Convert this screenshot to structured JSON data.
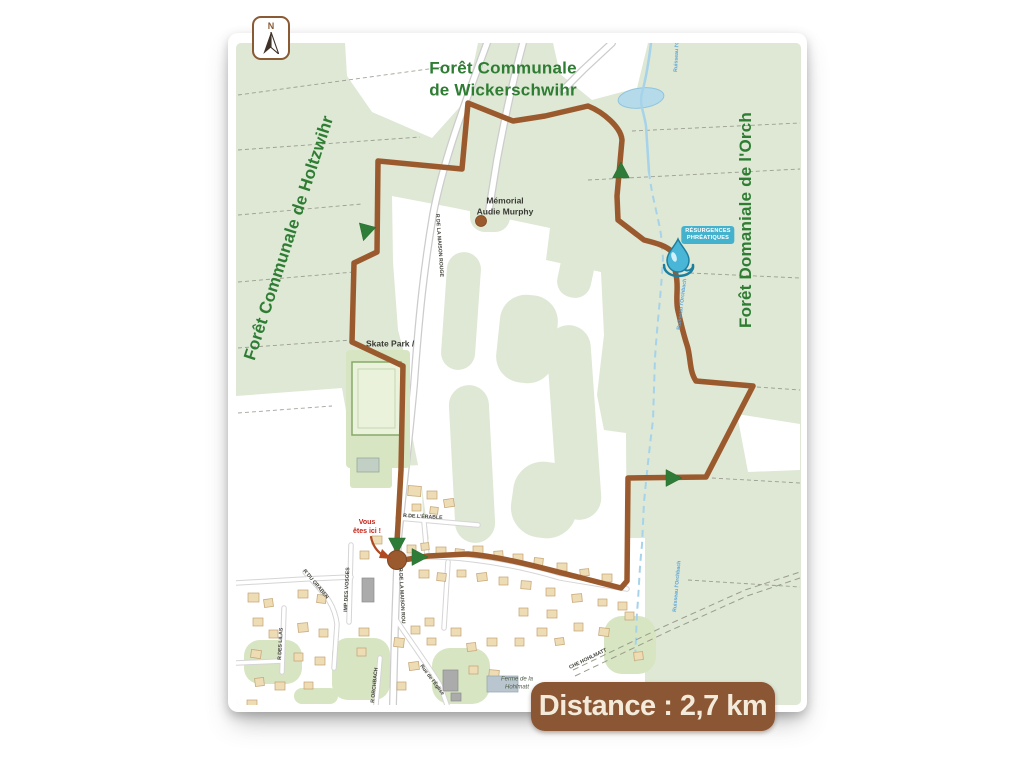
{
  "distance_badge": {
    "label": "Distance : 2,7 km"
  },
  "compass": {
    "letter": "N"
  },
  "forest_labels": [
    {
      "line1": "Forêt Communale",
      "line2": "de Wickerschwihr"
    },
    {
      "line1": "Forêt Communale de Holtzwihr"
    },
    {
      "line1": "Forêt Domaniale de l'Orch"
    }
  ],
  "poi": {
    "memorial": {
      "line1": "Mémorial",
      "line2": "Audie Murphy"
    },
    "skatepark": {
      "label": "Skate Park /"
    },
    "you_are_here": {
      "line1": "Vous",
      "line2": "êtes ici !"
    },
    "farm": {
      "line1": "Ferme de la",
      "line2": "Hohlmatt"
    },
    "resurgences": {
      "line1": "RÉSURGENCES",
      "line2": "PHRÉATIQUES"
    }
  },
  "street_labels": [
    {
      "text": "R DE LA MAISON ROUGE",
      "x": 436,
      "y": 214,
      "rot": 86
    },
    {
      "text": "R DE LA MAISON ROU",
      "x": 399,
      "y": 568,
      "rot": 87
    },
    {
      "text": "R DE L'ÉRABLE",
      "x": 403,
      "y": 517,
      "rot": 3
    },
    {
      "text": "IMP DES VOSGES",
      "x": 347,
      "y": 612,
      "rot": -87
    },
    {
      "text": "Rue de l'Église",
      "x": 420,
      "y": 666,
      "rot": 53
    },
    {
      "text": "R ORCHBACH",
      "x": 374,
      "y": 703,
      "rot": -84
    },
    {
      "text": "R DES LILAS",
      "x": 281,
      "y": 660,
      "rot": -87
    },
    {
      "text": "R DU GRABEN",
      "x": 303,
      "y": 571,
      "rot": 50
    },
    {
      "text": "CHE HOHLMATT",
      "x": 570,
      "y": 669,
      "rot": -26
    }
  ],
  "stream_labels": [
    {
      "text": "Ruisseau l'Orch",
      "x": 677,
      "y": 72,
      "rot": -87
    },
    {
      "text": "Ruisseau l'Orchbach",
      "x": 680,
      "y": 330,
      "rot": -83
    },
    {
      "text": "Ruisseau l'Orchbach",
      "x": 676,
      "y": 612,
      "rot": -85
    }
  ],
  "colors": {
    "forest": "#dee8d5",
    "clearing": "#ffffff",
    "park": "#d7e5c2",
    "trail": "#9b5a2d",
    "trail_dark": "#7e451f",
    "arrow": "#2e7c37",
    "water": "#a6d3ea",
    "water_text": "#5aa3d8",
    "building": "#eedcb4",
    "building_stroke": "#c3a273",
    "gray_building": "#ababab",
    "gray_building_stroke": "#8d8d8d",
    "blue_building": "#b9c6cf",
    "blue_building_stroke": "#93a3ad",
    "road_casing": "#cccccc",
    "parcel": "#85857a",
    "street_text": "#44443c",
    "drop_fill": "#49b6d7",
    "drop_stroke": "#1d7f9e",
    "yah_arrow": "#b04a22"
  },
  "geometry": {
    "map_rect": [
      236,
      43,
      565,
      662
    ],
    "clearings": [
      "M345,43 L478,43 L466,100 L432,138 L372,112 L347,76 Z",
      "M553,43 L648,43 L637,88 L592,100 L560,74 Z",
      "M392,196 L455,208 L550,228 L546,260 L601,272 L604,335 L597,395 L604,430 L626,433 L627,588 L560,583 L500,560 L430,548 L421,480 L409,420 L408,368 L398,330 L393,262 Z",
      "M236,396 L342,388 L356,468 L421,465 L424,545 L236,548 Z",
      "M236,540 L645,538 L645,705 L236,705 Z",
      "M737,414 L800,424 L800,470 L748,472 Z"
    ],
    "forest_patches": [
      [
        444,
        252,
        34,
        118,
        17,
        4
      ],
      [
        452,
        385,
        40,
        158,
        20,
        -3
      ],
      [
        498,
        295,
        58,
        88,
        26,
        6
      ],
      [
        552,
        325,
        44,
        195,
        22,
        -4
      ],
      [
        512,
        462,
        66,
        76,
        30,
        8
      ],
      [
        470,
        196,
        40,
        36,
        15,
        0
      ],
      [
        560,
        238,
        34,
        60,
        16,
        12
      ]
    ],
    "parks": [
      [
        332,
        638,
        58,
        62,
        16
      ],
      [
        432,
        648,
        58,
        56,
        18
      ],
      [
        244,
        640,
        58,
        44,
        16
      ],
      [
        604,
        616,
        52,
        58,
        18
      ],
      [
        294,
        688,
        44,
        16,
        8
      ]
    ],
    "parcel_lines": [
      "M238,95 L465,64",
      "M238,150 L420,137",
      "M238,215 L362,204",
      "M238,282 L354,272",
      "M238,348 L352,340",
      "M238,413 L332,406",
      "M588,180 L800,169",
      "M632,131 L800,123",
      "M690,273 L800,278",
      "M757,387 L800,390",
      "M712,478 L800,483",
      "M688,580 L800,587"
    ],
    "pond": [
      641,
      98,
      23,
      10,
      -7
    ],
    "stream_solid": "M651,43 C649,60 646,78 642,93 C639,104 644,112 646,126 L649,172",
    "stream_dashed": "M649,172 C652,198 658,215 661,235 L663,258 C661,295 657,325 655,358 L653,420 C649,452 647,472 644,502 L642,545 C639,572 639,592 637,612 L635,662",
    "roads_main": [
      "M487,43 C468,95 443,160 433,215 C424,268 419,315 414,385 C409,440 402,500 398,540 L395,625 L393,705",
      "M612,43 L583,70 L563,90",
      "M523,43 C513,80 504,122 497,160 L489,210"
    ],
    "roads_village": [
      "M398,518 L478,525",
      "M351,545 L349,622",
      "M305,572 C320,590 334,600 337,624 L334,668",
      "M284,608 L282,672",
      "M395,618 C410,641 426,662 440,685 L447,705",
      "M380,658 L376,705",
      "M236,583 L305,579 L351,577",
      "M236,663 L282,661",
      "M399,558 C440,554 500,560 560,578 L627,589",
      "M448,562 L444,628",
      "M424,522 L427,556"
    ],
    "dashed_roads": [
      "M573,670 L665,626 L745,590 L800,572",
      "M575,676 L667,632 L747,596 L800,578"
    ],
    "sports": {
      "strip": [
        346,
        350,
        64,
        118
      ],
      "field": [
        352,
        362,
        49,
        73
      ],
      "inner": [
        358,
        369,
        37,
        59
      ],
      "annex": [
        350,
        452,
        42,
        36
      ],
      "annex_bldg": [
        357,
        458,
        22,
        14
      ]
    },
    "buildings": [
      [
        408,
        486,
        13,
        10,
        4,
        0
      ],
      [
        427,
        491,
        10,
        8,
        0,
        0
      ],
      [
        444,
        499,
        10,
        8,
        -8,
        0
      ],
      [
        412,
        504,
        9,
        7,
        0,
        0
      ],
      [
        430,
        507,
        8,
        7,
        6,
        0
      ],
      [
        372,
        536,
        10,
        8,
        0,
        0
      ],
      [
        360,
        551,
        9,
        8,
        0,
        0
      ],
      [
        407,
        545,
        9,
        8,
        0,
        0
      ],
      [
        421,
        543,
        8,
        7,
        -5,
        0
      ],
      [
        436,
        547,
        10,
        8,
        0,
        0
      ],
      [
        455,
        549,
        9,
        7,
        5,
        0
      ],
      [
        473,
        546,
        10,
        8,
        0,
        0
      ],
      [
        494,
        551,
        9,
        8,
        -4,
        0
      ],
      [
        513,
        554,
        10,
        8,
        0,
        0
      ],
      [
        534,
        558,
        9,
        8,
        6,
        0
      ],
      [
        557,
        563,
        10,
        8,
        0,
        0
      ],
      [
        580,
        569,
        9,
        7,
        -5,
        0
      ],
      [
        602,
        574,
        10,
        8,
        0,
        0
      ],
      [
        419,
        570,
        10,
        8,
        0,
        0
      ],
      [
        437,
        573,
        9,
        8,
        5,
        0
      ],
      [
        457,
        570,
        9,
        7,
        0,
        0
      ],
      [
        477,
        573,
        10,
        8,
        -6,
        0
      ],
      [
        499,
        577,
        9,
        8,
        0,
        0
      ],
      [
        521,
        581,
        10,
        8,
        4,
        0
      ],
      [
        546,
        588,
        9,
        8,
        0,
        0
      ],
      [
        572,
        594,
        10,
        8,
        -5,
        0
      ],
      [
        598,
        599,
        9,
        7,
        0,
        0
      ],
      [
        618,
        602,
        9,
        8,
        0,
        0
      ],
      [
        248,
        593,
        11,
        9,
        0,
        0
      ],
      [
        264,
        599,
        9,
        8,
        -7,
        0
      ],
      [
        298,
        590,
        10,
        8,
        0,
        0
      ],
      [
        317,
        595,
        9,
        8,
        6,
        0
      ],
      [
        253,
        618,
        10,
        8,
        0,
        0
      ],
      [
        269,
        630,
        9,
        8,
        0,
        0
      ],
      [
        298,
        623,
        10,
        9,
        -5,
        0
      ],
      [
        319,
        629,
        9,
        8,
        0,
        0
      ],
      [
        251,
        650,
        10,
        8,
        7,
        0
      ],
      [
        294,
        653,
        9,
        8,
        0,
        0
      ],
      [
        315,
        657,
        10,
        8,
        0,
        0
      ],
      [
        255,
        678,
        9,
        8,
        -6,
        0
      ],
      [
        275,
        682,
        10,
        8,
        0,
        0
      ],
      [
        304,
        682,
        9,
        7,
        0,
        0
      ],
      [
        247,
        700,
        10,
        6,
        0,
        0
      ],
      [
        359,
        628,
        10,
        8,
        0,
        0
      ],
      [
        357,
        648,
        9,
        8,
        0,
        0
      ],
      [
        394,
        638,
        10,
        9,
        6,
        0
      ],
      [
        411,
        626,
        9,
        8,
        0,
        0
      ],
      [
        409,
        662,
        10,
        8,
        -7,
        0
      ],
      [
        397,
        682,
        9,
        8,
        0,
        0
      ],
      [
        427,
        638,
        9,
        7,
        0,
        0
      ],
      [
        425,
        618,
        9,
        8,
        0,
        0
      ],
      [
        451,
        628,
        10,
        8,
        0,
        0
      ],
      [
        467,
        643,
        9,
        8,
        -6,
        0
      ],
      [
        487,
        638,
        10,
        8,
        0,
        0
      ],
      [
        469,
        666,
        9,
        8,
        0,
        0
      ],
      [
        489,
        670,
        10,
        8,
        5,
        0
      ],
      [
        515,
        638,
        9,
        8,
        0,
        0
      ],
      [
        537,
        628,
        10,
        8,
        0,
        0
      ],
      [
        555,
        638,
        9,
        7,
        -7,
        0
      ],
      [
        519,
        608,
        9,
        8,
        0,
        0
      ],
      [
        547,
        610,
        10,
        8,
        0,
        0
      ],
      [
        574,
        623,
        9,
        8,
        0,
        0
      ],
      [
        599,
        628,
        10,
        8,
        6,
        0
      ],
      [
        625,
        612,
        9,
        8,
        0,
        0
      ],
      [
        634,
        652,
        9,
        8,
        -5,
        0
      ],
      [
        362,
        578,
        12,
        24,
        0,
        1
      ],
      [
        443,
        670,
        15,
        21,
        0,
        1
      ],
      [
        451,
        693,
        10,
        8,
        0,
        1
      ],
      [
        487,
        676,
        31,
        16,
        0,
        2
      ]
    ],
    "trail": "M397,561 L428,556 L468,554 C505,557 545,569 582,578 L621,588 L627,581 L628,478 L706,477 L753,386 L696,381 C689,371 691,357 687,345 C683,333 681,323 678,311 C675,299 679,287 676,275 L672,252 C667,246 656,243 644,240 L618,220 L617,196 L622,140 C621,127 603,112 588,106 L545,116 L513,121 L468,103 L462,169 L378,161 L377,252 L354,263 L352,342 L403,366 L401,470 L397,543 L397,556",
    "arrows": [
      [
        366,
        231,
        195
      ],
      [
        621,
        172,
        0
      ],
      [
        672,
        478,
        90
      ],
      [
        397,
        544,
        180
      ],
      [
        418,
        557,
        90
      ]
    ],
    "start_circle": [
      397,
      560,
      9.5
    ],
    "memorial_dot": [
      481,
      221,
      5.5
    ],
    "drop": {
      "cx": 678,
      "cy": 256
    },
    "yah_arrow": {
      "path": "M371,537 C373,547 378,553 386,557",
      "head": "M382,549 L392,559 L379,558 Z"
    }
  }
}
